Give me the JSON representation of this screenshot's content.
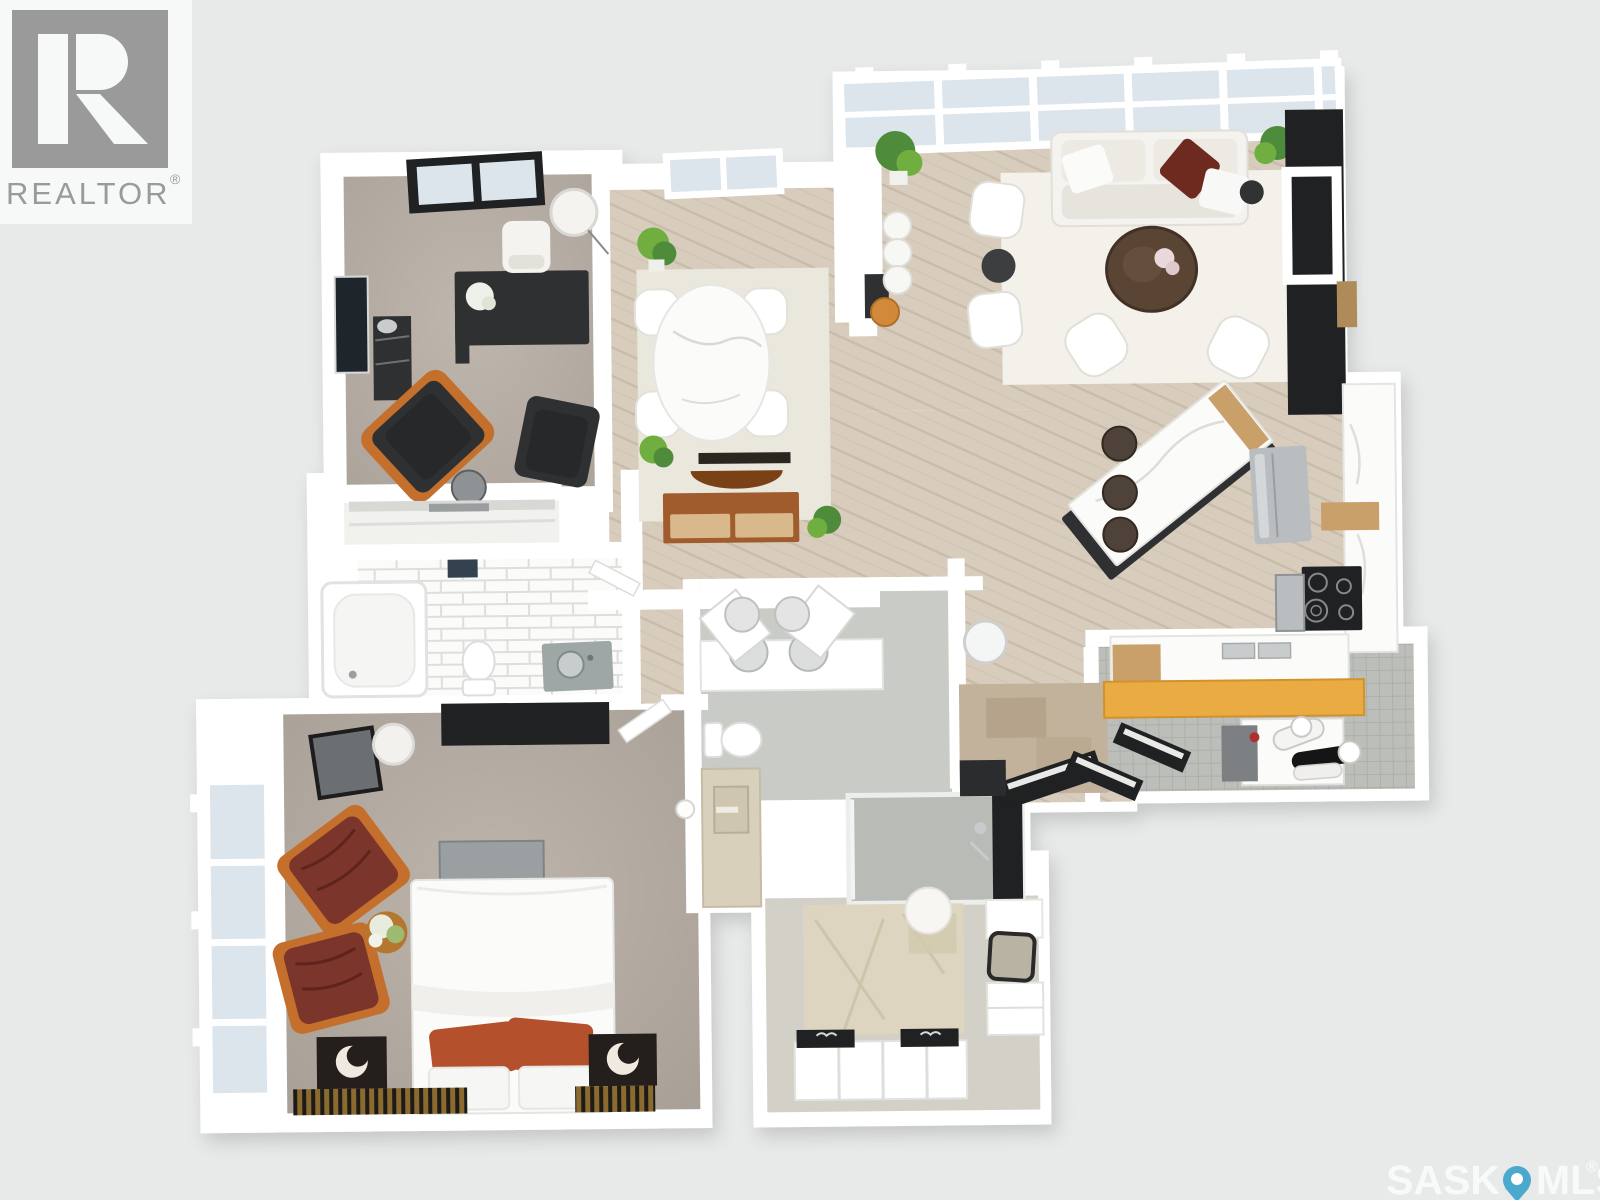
{
  "background_color": "#e8eaea",
  "branding": {
    "logo_text": "REALTOR",
    "registered": "®",
    "logo_color": "#9a9a9a",
    "logo_icon": "realtor-block-r-icon"
  },
  "watermark": {
    "prefix": "SASK",
    "suffix": "MLS",
    "registered": "®",
    "pin_icon": "map-pin-icon",
    "pin_color": "#4aa9cc",
    "text_color": "#fafbfb"
  },
  "floor_plan": {
    "view": "3D top-down rendered apartment floor plan",
    "palette": {
      "walls": "#ffffff",
      "wood_floor": "#d8cdbd",
      "carpet": "#b7aea5",
      "glass": "#dde5ec",
      "accent_dark": "#2e3032",
      "accent_rust": "#b4512c",
      "accent_maroon": "#7c352a",
      "accent_yellow": "#eaab43",
      "accent_wood": "#a05c2c"
    },
    "rooms": [
      {
        "name": "office-den",
        "floor": "grey carpet",
        "furniture": [
          "black desk with flowers",
          "white desk chair",
          "white drum floor lamp",
          "dark recliner with orange arms",
          "dark armchair",
          "round side table",
          "dark shelf unit",
          "wall art",
          "black framed window"
        ]
      },
      {
        "name": "dining-room",
        "floor": "wood",
        "furniture": [
          "oval marble dining table",
          "four white chairs",
          "cream area rug",
          "potted plants",
          "wood console with drawers",
          "decorative wood bowl",
          "white framed window"
        ]
      },
      {
        "name": "living-room",
        "floor": "wood",
        "furniture": [
          "white sofa with maroon pillow",
          "round dark wood coffee table with flowers",
          "four white armchairs",
          "dark round side tables",
          "white area rug",
          "fiddle leaf plants",
          "black wall unit with white media frame",
          "full-width glazed window band",
          "three white counter stools",
          "orange stool"
        ]
      },
      {
        "name": "kitchen",
        "floor": "wood",
        "furniture": [
          "waterfall marble island with black base",
          "three dark bar stools",
          "stainless fridge",
          "black cooktop",
          "stainless microwave",
          "marble counters",
          "double sink",
          "wood cabinet accents"
        ]
      },
      {
        "name": "main-bathroom",
        "floor": "white subway tile",
        "furniture": [
          "bathtub",
          "toilet",
          "grey vanity with round sink",
          "hall closet",
          "door"
        ]
      },
      {
        "name": "bedroom",
        "floor": "grey carpet",
        "furniture": [
          "bed with white duvet and two rust pillows",
          "grey bench",
          "two dark nightstands with crescent lamps",
          "two striped runner rugs",
          "two maroon wood-frame armchairs",
          "round flower table",
          "dark dresser",
          "dark framed mirror",
          "white drum floor lamp",
          "floor-to-ceiling window band"
        ]
      },
      {
        "name": "ensuite-bathroom",
        "floor": "grey tile",
        "furniture": [
          "double vanity with two round sinks",
          "open cabinet doors",
          "toilet",
          "beige counter",
          "glass walk-in shower",
          "round mirror"
        ]
      },
      {
        "name": "entry-hall",
        "floor": "wood",
        "furniture": [
          "distressed tan rug",
          "round mirror",
          "dark bench",
          "open dark door"
        ]
      },
      {
        "name": "walk-in-closet",
        "floor": "light carpet",
        "furniture": [
          "patterned beige rug",
          "white pouf",
          "white shoe cubbies with black tops",
          "white drawer unit",
          "dark framed mirror"
        ]
      },
      {
        "name": "laundry-room",
        "floor": "grey tile",
        "furniture": [
          "yellow wood counter",
          "washer and dryer",
          "rolled linens",
          "open black doors"
        ]
      }
    ]
  }
}
